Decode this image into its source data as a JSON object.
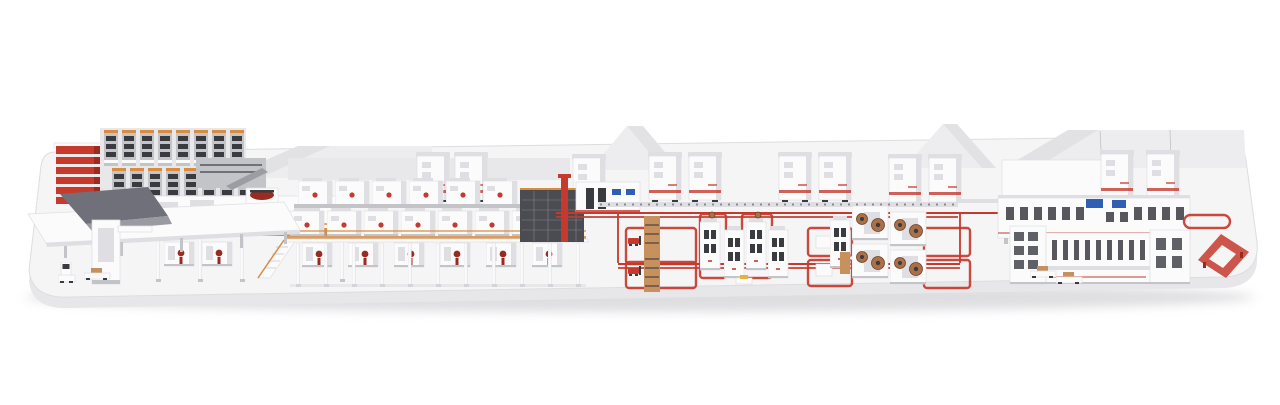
{
  "scene": {
    "title": "Isometric 3D render of a complete industrial production line on a white platform",
    "colors": {
      "bg": "#ffffff",
      "platform_top": "#f5f5f6",
      "platform_front": "#e7e7ea",
      "platform_edge": "#dddde1",
      "shadow": "#c9c9cd",
      "roof_light": "#ededef",
      "roof_mid": "#e2e2e5",
      "backdrop": "#e8e8ea",
      "machine_white": "#fbfbfc",
      "machine_shade": "#dfdfe3",
      "machine_gray": "#c3c4c8",
      "steel_gray": "#9c9ca3",
      "dark_panel": "#4b4b52",
      "dark_slot": "#3a3a41",
      "accent_red": "#c63a2e",
      "deep_red": "#9a2b21",
      "accent_orange": "#d98b3f",
      "wood_tan": "#c6915c",
      "copper": "#ab7048",
      "copper_dark": "#6d4026",
      "screen_blue": "#2f5fb3",
      "accent_yellow": "#e5b23c",
      "ramp_dark": "#70707a",
      "ramp_mid": "#9a9aa2"
    },
    "groups": [
      "showroom-platform",
      "factory-roofline",
      "high-bay-storage-rack",
      "red-utility-tower",
      "infeed-ramp-deck",
      "mezzanine-coating-section",
      "multi-deck-oven-line",
      "oven-end-dark-section",
      "control-cabinet-wall",
      "background-oven-cabinets",
      "overhead-conveyor",
      "agv-floor-loops",
      "machine-cell-1",
      "machine-cell-2",
      "finishing-line-back-row",
      "finishing-line-front-row",
      "racetrack-conveyor",
      "pallet-circulation-loop",
      "mobile-robots"
    ]
  }
}
